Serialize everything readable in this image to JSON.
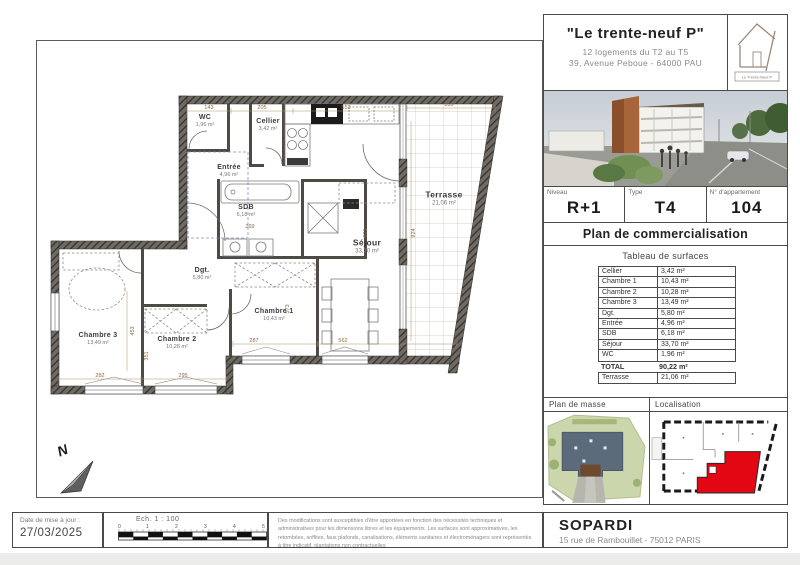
{
  "header": {
    "title": "\"Le trente-neuf P\"",
    "subtitle1": "12 logements du T2 au T5",
    "subtitle2": "39, Avenue Peboue - 64000 PAU",
    "logo_label": "Le Trente-Neuf P"
  },
  "unit_info": {
    "niveau_label": "Niveau",
    "niveau": "R+1",
    "type_label": "Type",
    "type": "T4",
    "apt_label": "N° d'appartement",
    "apt": "104"
  },
  "section_title": "Plan de commercialisation",
  "surfaces": {
    "title": "Tableau de surfaces",
    "rows": [
      {
        "label": "Cellier",
        "value": "3,42 m²"
      },
      {
        "label": "Chambre 1",
        "value": "10,43 m²"
      },
      {
        "label": "Chambre 2",
        "value": "10,28 m²"
      },
      {
        "label": "Chambre 3",
        "value": "13,49 m²"
      },
      {
        "label": "Dgt.",
        "value": "5,80 m²"
      },
      {
        "label": "Entrée",
        "value": "4,96 m²"
      },
      {
        "label": "SDB",
        "value": "6,18 m²"
      },
      {
        "label": "Séjour",
        "value": "33,70 m²"
      },
      {
        "label": "WC",
        "value": "1,96 m²"
      }
    ],
    "total": {
      "label": "TOTAL",
      "value": "90,22 m²"
    },
    "terrasse": {
      "label": "Terrasse",
      "value": "21,06 m²"
    }
  },
  "maps": {
    "masse_label": "Plan de masse",
    "localisation_label": "Localisation"
  },
  "footer": {
    "date_label": "Date de mise à jour :",
    "date": "27/03/2025",
    "scale_label": "Ech. 1 : 100",
    "scale_ticks": [
      "0",
      "1",
      "2",
      "3",
      "4",
      "5"
    ],
    "disclaimer": "Des modifications sont susceptibles d'être apportées en fonction des nécessités techniques et administratives pour les dimensions libres et les équipements. Les surfaces sont approximatives, les retombées, soffites, faux plafonds, canalisations, éléments sanitaires et électroménagers sont représentés à titre indicatif, plantations non contractuelles",
    "company": "SOPARDI",
    "address": "15 rue de Rambouillet - 75012 PARIS"
  },
  "plan": {
    "north_label": "N",
    "rooms": [
      {
        "name": "WC",
        "area": "1,96 m²"
      },
      {
        "name": "Cellier",
        "area": "3,42 m²"
      },
      {
        "name": "Entrée",
        "area": "4,96 m²"
      },
      {
        "name": "SDB",
        "area": "6,18 m²"
      },
      {
        "name": "Dgt.",
        "area": "5,80 m²"
      },
      {
        "name": "Chambre 1",
        "area": "10,43 m²"
      },
      {
        "name": "Chambre 2",
        "area": "10,28 m²"
      },
      {
        "name": "Chambre 3",
        "area": "13,49 m²"
      },
      {
        "name": "Séjour",
        "area": "33,70 m²"
      },
      {
        "name": "Terrasse",
        "area": "21,06 m²"
      }
    ],
    "dims": [
      "143",
      "205",
      "552",
      "359",
      "282",
      "295",
      "287",
      "562",
      "269",
      "453",
      "351",
      "573",
      "924",
      "921"
    ]
  }
}
